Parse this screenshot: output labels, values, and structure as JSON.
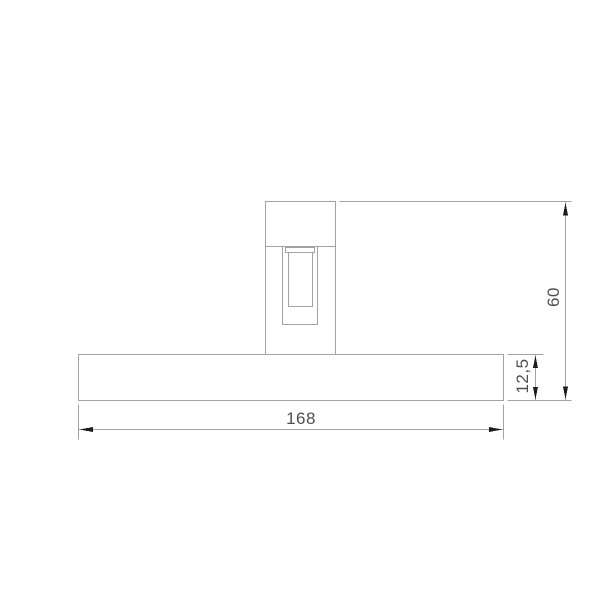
{
  "drawing": {
    "title": "fixture-dimension-drawing",
    "dimensions": {
      "width": {
        "label": "168"
      },
      "height": {
        "label": "60"
      },
      "base_thickness": {
        "label": "12,5"
      }
    },
    "colors": {
      "background": "#ffffff",
      "line": "#a3a3a3",
      "text": "#4f4f4f",
      "arrow": "#1c1c1c"
    }
  }
}
